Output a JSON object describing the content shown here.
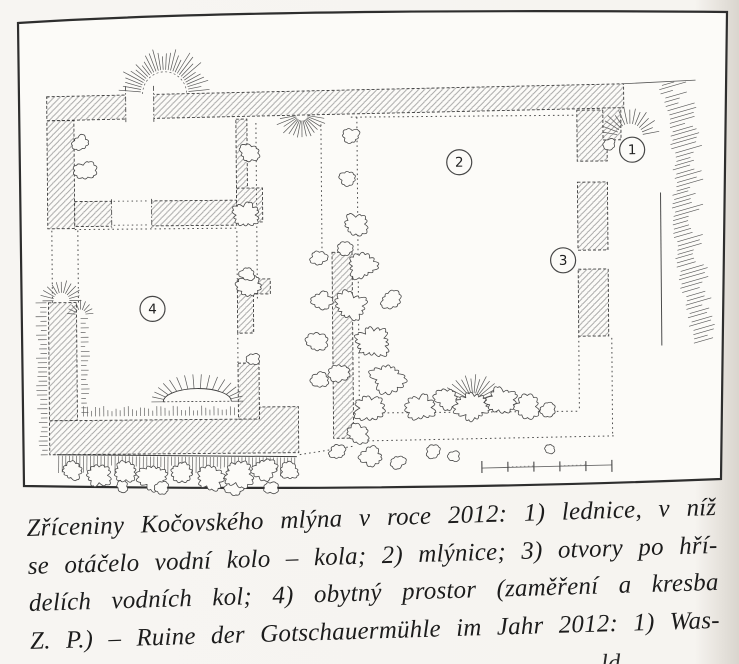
{
  "figure": {
    "markers": [
      {
        "label": "1",
        "x": 633,
        "y": 152
      },
      {
        "label": "2",
        "x": 460,
        "y": 163
      },
      {
        "label": "3",
        "x": 563,
        "y": 262
      },
      {
        "label": "4",
        "x": 152,
        "y": 307
      }
    ],
    "scale_bar": {
      "segments": 5
    }
  },
  "caption": {
    "lines": [
      "Zříceniny Kočovského mlýna v roce 2012: 1) lednice, v níž",
      "se otáčelo vodní kolo – kola; 2) mlýnice; 3) otvory po hří-",
      "delích vodních kol; 4) obytný prostor (zaměření a kresba",
      "Z. P.) – Ruine der Gotschauermühle im Jahr 2012: 1) Was-"
    ],
    "partial_next_line_fragment": "ld"
  }
}
